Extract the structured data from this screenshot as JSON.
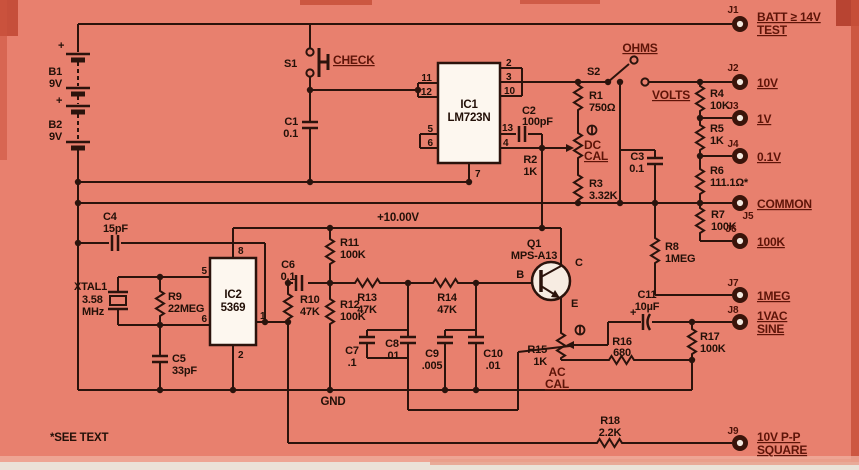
{
  "colors": {
    "background": "#e8806e",
    "wire": "#2b130c",
    "component_label": "#231008",
    "jack_label": "#5e1408",
    "ic_fill": "#fdf7ef",
    "jack_hole": "#f2e8de"
  },
  "labels": {
    "vref": "+10.00V",
    "gnd": "GND",
    "note": "*SEE TEXT"
  },
  "symbols": {
    "plus": "+"
  },
  "batteries": {
    "b1": {
      "ref": "B1",
      "value": "9V"
    },
    "b2": {
      "ref": "B2",
      "value": "9V"
    }
  },
  "switches": {
    "s1": {
      "ref": "S1",
      "label": "CHECK"
    },
    "s2": {
      "ref": "S2",
      "pos_ohms": "OHMS",
      "pos_volts": "VOLTS"
    }
  },
  "ics": {
    "ic1": {
      "ref": "IC1",
      "part": "LM723N",
      "pins": {
        "p11": "11",
        "p12": "12",
        "p5": "5",
        "p6": "6",
        "p2": "2",
        "p3": "3",
        "p10": "10",
        "p13": "13",
        "p4": "4",
        "p7": "7"
      }
    },
    "ic2": {
      "ref": "IC2",
      "part": "5369",
      "pins": {
        "p8": "8",
        "p5": "5",
        "p6": "6",
        "p1": "1",
        "p2": "2"
      }
    }
  },
  "transistor": {
    "ref": "Q1",
    "part": "MPS-A13",
    "b": "B",
    "c": "C",
    "e": "E"
  },
  "crystal": {
    "ref": "XTAL1",
    "value_line1": "3.58",
    "value_line2": "MHz"
  },
  "trimmers": {
    "dc": {
      "line1": "DC",
      "line2": "CAL"
    },
    "ac": {
      "line1": "AC",
      "line2": "CAL"
    }
  },
  "resistors": {
    "r1": {
      "ref": "R1",
      "value": "750Ω"
    },
    "r2": {
      "ref": "R2",
      "value": "1K"
    },
    "r3": {
      "ref": "R3",
      "value": "3.32K"
    },
    "r4": {
      "ref": "R4",
      "value": "10K"
    },
    "r5": {
      "ref": "R5",
      "value": "1K"
    },
    "r6": {
      "ref": "R6",
      "value": "111.1Ω*"
    },
    "r7": {
      "ref": "R7",
      "value": "100K"
    },
    "r8": {
      "ref": "R8",
      "value": "1MEG"
    },
    "r9": {
      "ref": "R9",
      "value": "22MEG"
    },
    "r10": {
      "ref": "R10",
      "value": "47K"
    },
    "r11": {
      "ref": "R11",
      "value": "100K"
    },
    "r12": {
      "ref": "R12",
      "value": "100K"
    },
    "r13": {
      "ref": "R13",
      "value": "47K"
    },
    "r14": {
      "ref": "R14",
      "value": "47K"
    },
    "r15": {
      "ref": "R15",
      "value": "1K"
    },
    "r16": {
      "ref": "R16",
      "value": "680"
    },
    "r17": {
      "ref": "R17",
      "value": "100K"
    },
    "r18": {
      "ref": "R18",
      "value": "2.2K"
    }
  },
  "capacitors": {
    "c1": {
      "ref": "C1",
      "value": "0.1"
    },
    "c2": {
      "ref": "C2",
      "value": "100pF"
    },
    "c3": {
      "ref": "C3",
      "value": "0.1"
    },
    "c4": {
      "ref": "C4",
      "value": "15pF"
    },
    "c5": {
      "ref": "C5",
      "value": "33pF"
    },
    "c6": {
      "ref": "C6",
      "value": "0.1"
    },
    "c7": {
      "ref": "C7",
      "value": ".1"
    },
    "c8": {
      "ref": "C8",
      "value": ".01"
    },
    "c9": {
      "ref": "C9",
      "value": ".005"
    },
    "c10": {
      "ref": "C10",
      "value": ".01"
    },
    "c11": {
      "ref": "C11",
      "value": "10µF"
    }
  },
  "jacks": {
    "j1": {
      "ref": "J1",
      "line1": "BATT ≥ 14V",
      "line2": "TEST"
    },
    "j2": {
      "ref": "J2",
      "label": "10V"
    },
    "j3": {
      "ref": "J3",
      "label": "1V"
    },
    "j4": {
      "ref": "J4",
      "label": "0.1V"
    },
    "j5": {
      "ref": "J5",
      "label": "COMMON"
    },
    "j6": {
      "ref": "J6",
      "label": "100K"
    },
    "j7": {
      "ref": "J7",
      "label": "1MEG"
    },
    "j8": {
      "ref": "J8",
      "line1": "1VAC",
      "line2": "SINE"
    },
    "j9": {
      "ref": "J9",
      "line1": "10V P-P",
      "line2": "SQUARE"
    }
  }
}
